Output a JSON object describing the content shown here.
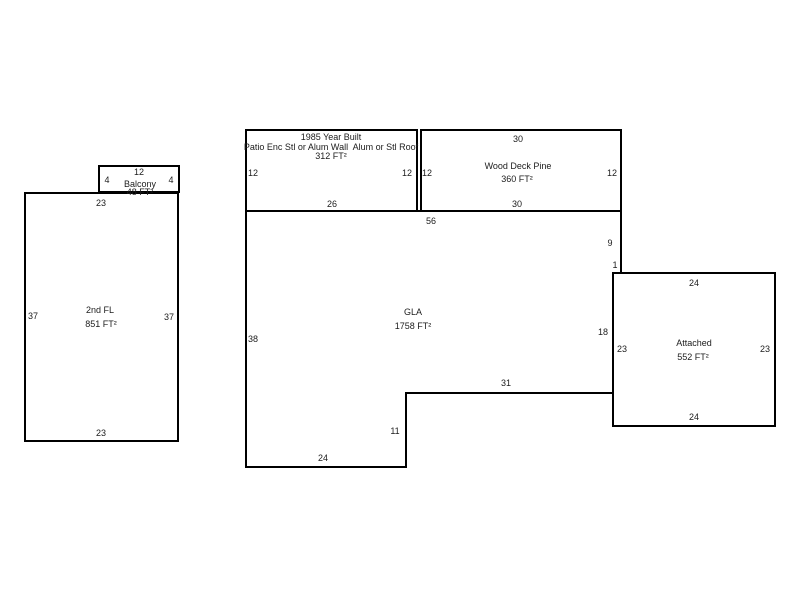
{
  "sketch": {
    "balcony": {
      "label": "Balcony",
      "area": "48 FT²",
      "dim_top": "12",
      "dim_left": "4",
      "dim_right": "4"
    },
    "second_floor": {
      "label": "2nd FL",
      "area": "851 FT²",
      "dim_top": "23",
      "dim_bottom": "23",
      "dim_left": "37",
      "dim_right": "37"
    },
    "patio": {
      "year_built": "1985 Year Built",
      "description": "Patio Enc Stl or Alum Wall  Alum or Stl Roof",
      "area": "312 FT²",
      "dim_left": "12",
      "dim_right": "12",
      "dim_bottom": "26"
    },
    "wood_deck": {
      "label": "Wood Deck Pine",
      "area": "360 FT²",
      "dim_top": "30",
      "dim_bottom": "30",
      "dim_left": "12",
      "dim_right": "12"
    },
    "gla": {
      "label": "GLA",
      "area": "1758 FT²",
      "dim_top": "56",
      "dim_right_upper": "9",
      "dim_notch": "1",
      "dim_right_lower": "18",
      "dim_bottom_right": "31",
      "dim_step": "11",
      "dim_bottom": "24",
      "dim_left": "38"
    },
    "attached": {
      "label": "Attached",
      "area": "552 FT²",
      "dim_top": "24",
      "dim_bottom": "24",
      "dim_left": "23",
      "dim_right": "23"
    },
    "line_color": "#000000",
    "background": "#ffffff"
  }
}
